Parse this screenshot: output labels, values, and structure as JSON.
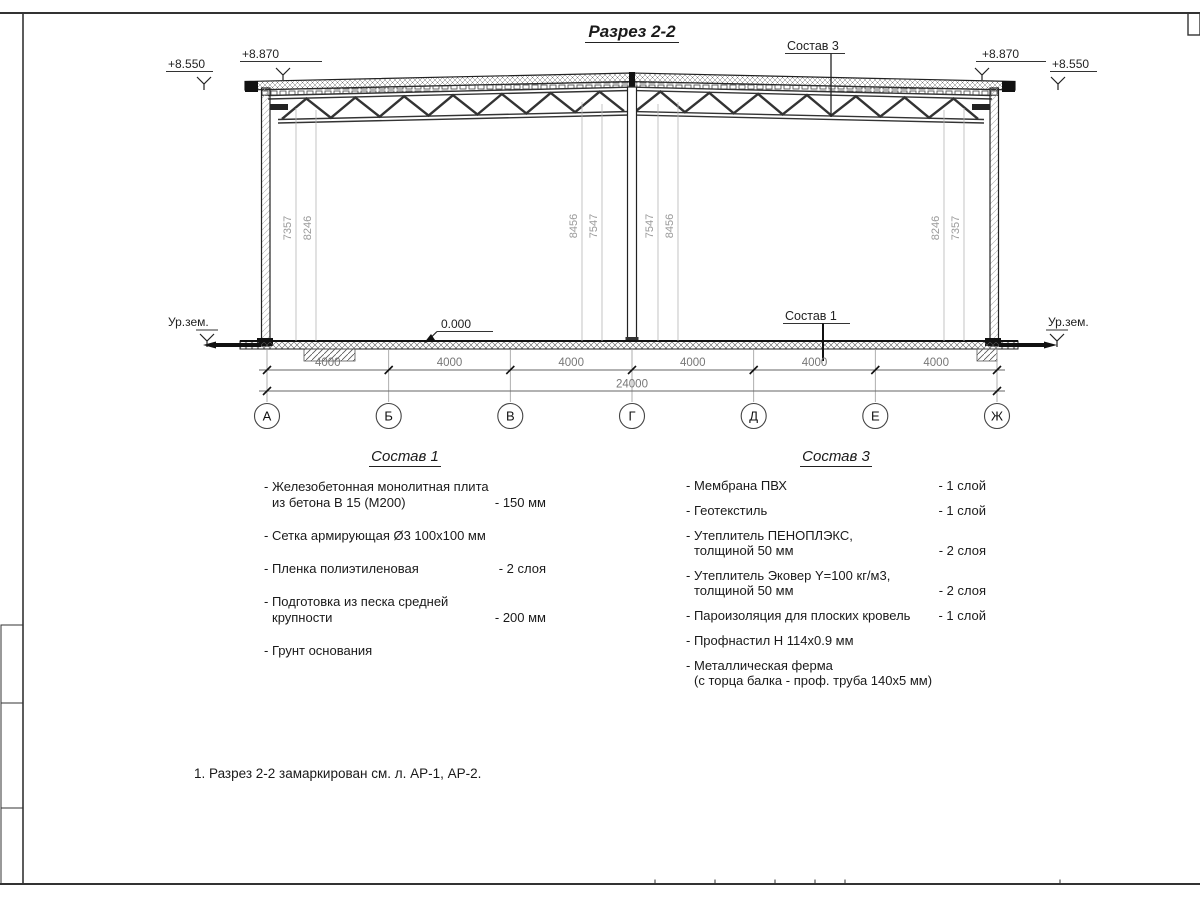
{
  "title": "Разрез 2-2",
  "elevations": {
    "left_outer": "+8.550",
    "left_roof": "+8.870",
    "right_roof": "+8.870",
    "right_outer": "+8.550"
  },
  "labels": {
    "ground_left": "Ур.зем.",
    "ground_right": "Ур.зем.",
    "zero_level": "0.000",
    "sostav3_leader": "Состав 3",
    "sostav1_leader": "Состав 1"
  },
  "heights": {
    "left_a": "7357",
    "left_b": "8246",
    "center_left_a": "8456",
    "center_left_b": "7547",
    "center_right_a": "7547",
    "center_right_b": "8456",
    "right_a": "8246",
    "right_b": "7357"
  },
  "dims": {
    "bays": [
      "4000",
      "4000",
      "4000",
      "4000",
      "4000",
      "4000"
    ],
    "total": "24000"
  },
  "axes": [
    "А",
    "Б",
    "В",
    "Г",
    "Д",
    "Е",
    "Ж"
  ],
  "sostav1": {
    "heading": "Состав 1",
    "items": [
      {
        "text": "- Железобетонная  монолитная плита",
        "text2": "из бетона В 15 (М200)",
        "value": "- 150 мм"
      },
      {
        "text": "- Сетка армирующая Ø3 100х100 мм",
        "text2": "",
        "value": ""
      },
      {
        "text": "- Пленка полиэтиленовая",
        "text2": "",
        "value": "-  2 слоя"
      },
      {
        "text": "- Подготовка из песка средней",
        "text2": "крупности",
        "value": "- 200 мм"
      },
      {
        "text": "- Грунт основания",
        "text2": "",
        "value": ""
      }
    ]
  },
  "sostav3": {
    "heading": "Состав 3",
    "items": [
      {
        "text": "- Мембрана ПВХ",
        "text2": "",
        "value": "- 1 слой"
      },
      {
        "text": "- Геотекстиль",
        "text2": "",
        "value": "- 1 слой"
      },
      {
        "text": "- Утеплитель ПЕНОПЛЭКС,",
        "text2": "толщиной 50 мм",
        "value": "- 2 слоя"
      },
      {
        "text": "- Утеплитель Эковер Y=100 кг/м3,",
        "text2": "толщиной 50 мм",
        "value": "- 2 слоя"
      },
      {
        "text": "- Пароизоляция для плоских кровель",
        "text2": "",
        "value": "- 1 слой"
      },
      {
        "text": "- Профнастил Н 114х0.9 мм",
        "text2": "",
        "value": ""
      },
      {
        "text": "- Металлическая ферма",
        "text2": "(с торца балка - проф. труба 140х5 мм)",
        "value": ""
      }
    ]
  },
  "note": "1. Разрез 2-2 замаркирован см. л. АР-1, АР-2."
}
